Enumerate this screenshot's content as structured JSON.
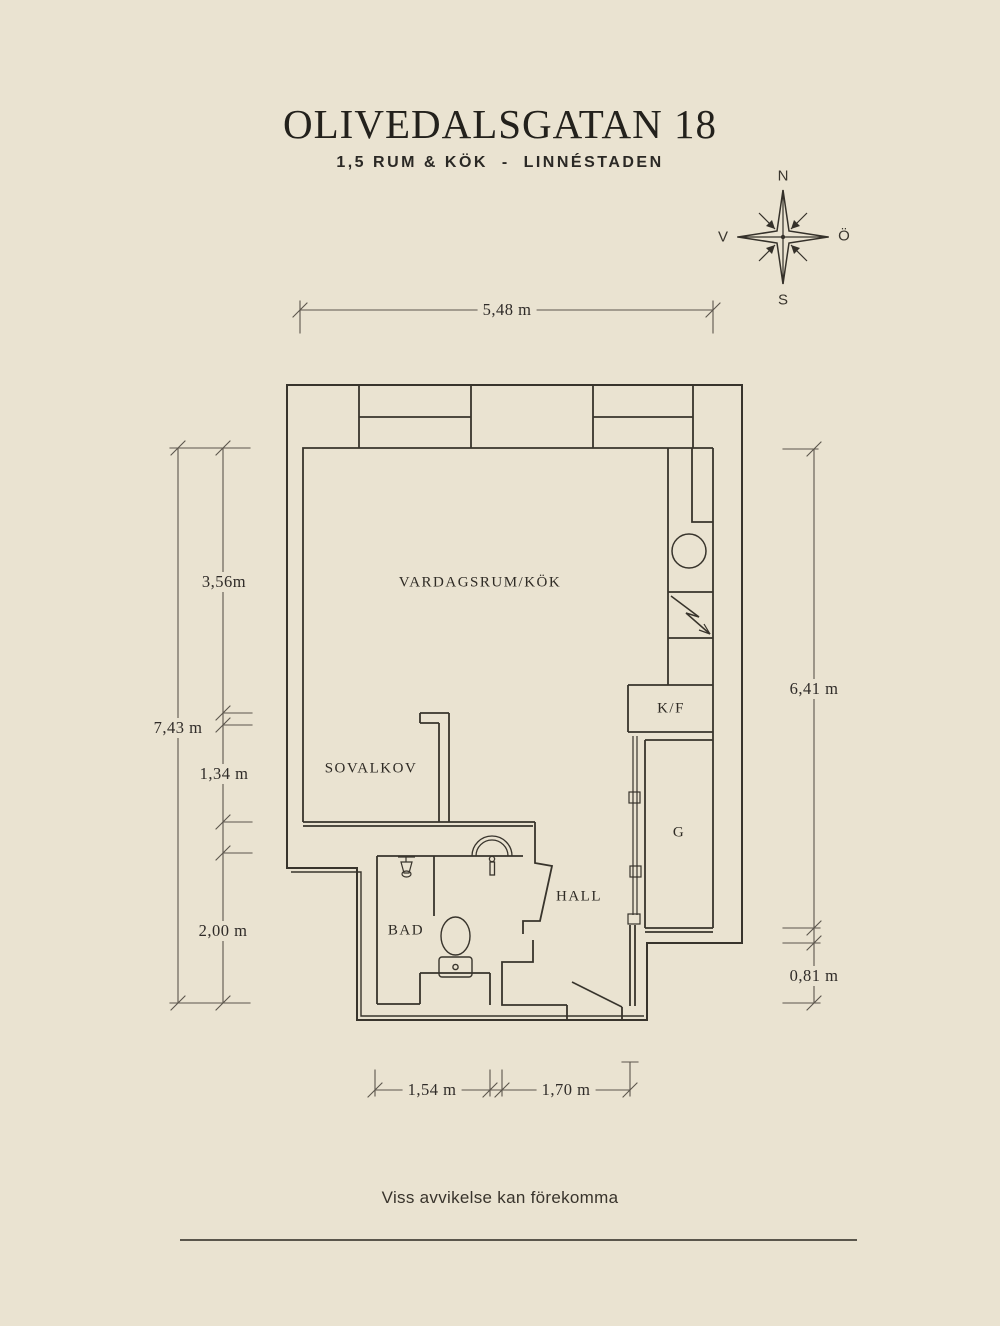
{
  "header": {
    "title": "OLIVEDALSGATAN 18",
    "subtitle": "1,5 RUM & KÖK  -  LINNÉSTADEN"
  },
  "compass": {
    "north": "N",
    "south": "S",
    "west": "V",
    "east": "Ö"
  },
  "rooms": {
    "living_kitchen": "VARDAGSRUM/KÖK",
    "sleeping_alcove": "SOVALKOV",
    "bathroom": "BAD",
    "hall": "HALL",
    "fridge_freezer": "K/F",
    "wardrobe": "G"
  },
  "dimensions": {
    "top_width": "5,48 m",
    "left_total": "7,43 m",
    "left_upper": "3,56m",
    "left_middle": "1,34 m",
    "left_lower": "2,00 m",
    "right_upper": "6,41 m",
    "right_lower": "0,81 m",
    "bottom_left": "1,54 m",
    "bottom_right": "1,70 m"
  },
  "footer": {
    "disclaimer": "Viss avvikelse kan förekomma"
  },
  "colors": {
    "background": "#eae3d1",
    "plan_line": "#38342c",
    "dimension_line": "#5c564d",
    "text": "#2c2923"
  }
}
